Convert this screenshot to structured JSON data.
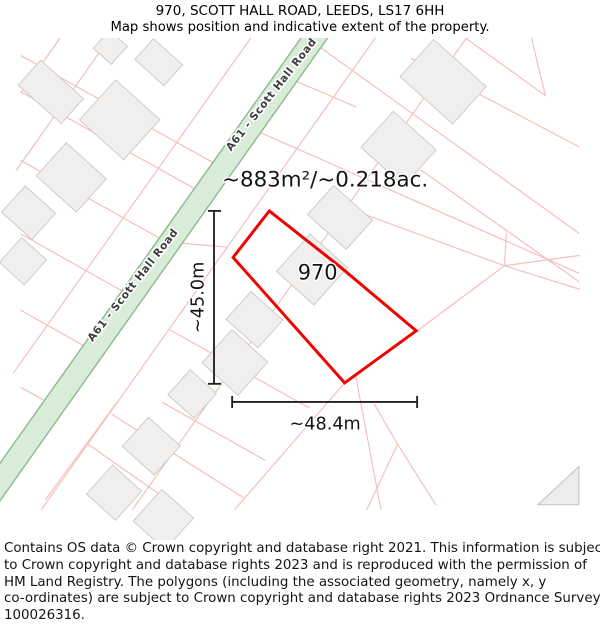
{
  "header": {
    "title": "970, SCOTT HALL ROAD, LEEDS, LS17 6HH",
    "subtitle": "Map shows position and indicative extent of the property."
  },
  "map": {
    "area_label": "~883m²/~0.218ac.",
    "plot_number": "970",
    "road_name": "A61 - Scott Hall Road",
    "dim_vertical_label": "~45.0m",
    "dim_horizontal_label": "~48.4m",
    "colors": {
      "boundary_red": "#ee0202",
      "road_fill": "#d9ecd8",
      "road_edge": "#85b687",
      "parcel_line": "#f4c0bc",
      "building_fill": "#f0efee",
      "dimension_line": "#222222"
    }
  },
  "footer": {
    "lines": [
      "Contains OS data © Crown copyright and database right 2021. This information is subject",
      "to Crown copyright and database rights 2023 and is reproduced with the permission of",
      "HM Land Registry. The polygons (including the associated geometry, namely x, y",
      "co-ordinates) are subject to Crown copyright and database rights 2023 Ordnance Survey",
      "100026316."
    ]
  }
}
